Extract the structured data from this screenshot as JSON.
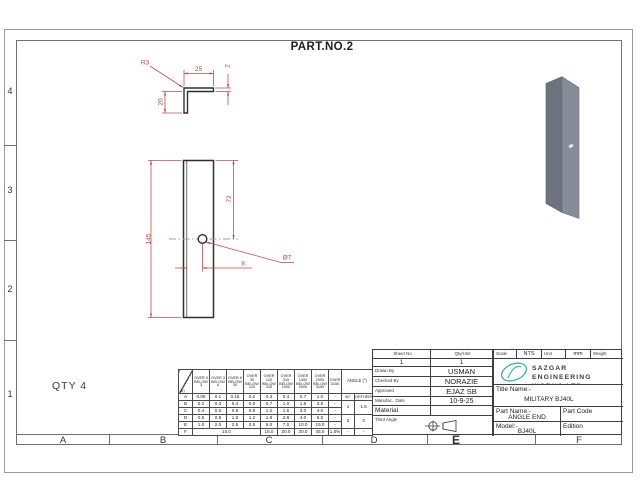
{
  "sheet": {
    "part_no": "PART.NO.2",
    "qty_note": "QTY 4"
  },
  "zones": {
    "letters": [
      "A",
      "B",
      "C",
      "D",
      "E",
      "F"
    ],
    "numbers": [
      "4",
      "3",
      "2",
      "1"
    ]
  },
  "dims": {
    "r3": "R3",
    "w25": "25",
    "t2": "2",
    "l20": "20",
    "h145": "145",
    "v72": "72",
    "dia": "Ø7",
    "off8": "8"
  },
  "tol": {
    "corner": "(±)",
    "col_headers": [
      "OVER 0 BELOW 3",
      "OVER 3 BELOW 6",
      "OVER 6 BELOW 30",
      "OVER 30 BELOW 120",
      "OVER 120 BELOW 315",
      "OVER 315 BELOW 1000",
      "OVER 1000 BELOW 2000",
      "OVER 2000 BELOW 3150",
      "OVER 3150"
    ],
    "angle_header": "ANGLE (°)",
    "rows": [
      {
        "label": "A",
        "v": [
          "0.05",
          "0.1",
          "0.15",
          "0.2",
          "0.3",
          "0.4",
          "0.7",
          "1.0",
          "-"
        ],
        "a": [
          "90°",
          "ORTHERS"
        ]
      },
      {
        "label": "B",
        "v": [
          "0.2",
          "0.3",
          "0.4",
          "0.5",
          "0.7",
          "1.0",
          "1.6",
          "2.5",
          "-"
        ],
        "a": [
          "1",
          "1.5"
        ]
      },
      {
        "label": "C",
        "v": [
          "0.4",
          "0.5",
          "0.6",
          "0.8",
          "1.2",
          "1.6",
          "3.0",
          "4.0",
          "-"
        ]
      },
      {
        "label": "D",
        "v": [
          "0.5",
          "0.8",
          "1.0",
          "1.2",
          "1.8",
          "2.8",
          "4.0",
          "6.0",
          "-"
        ],
        "a": [
          "2",
          "3"
        ]
      },
      {
        "label": "E",
        "v": [
          "1.0",
          "2.0",
          "2.5",
          "3.5",
          "5.0",
          "7.0",
          "10.0",
          "15.0",
          "-"
        ]
      },
      {
        "label": "F",
        "span": "10.0",
        "v": [
          "15.0",
          "20.0",
          "30.0",
          "45.0",
          "1.5%"
        ],
        "a": [
          "-",
          "-"
        ]
      }
    ]
  },
  "tb": {
    "sheet_no_label": "Sheet No",
    "sheet_no": "1",
    "qty_unit_label": "Qty/Unit",
    "qty_unit": "1",
    "scale_label": "Scale",
    "scale": "NTS",
    "unit_label": "Unit",
    "unit": "mm",
    "weight_label": "Weight",
    "drawn_by_label": "Drawn By",
    "drawn_by": "USMAN",
    "checked_by_label": "Checked By",
    "checked_by": "NORAZIE",
    "approved_label": "Approved",
    "approved": "EJAZ SB",
    "date_label": "Manufac., Date",
    "date": "10-9-25",
    "material_label": "Material",
    "material": "",
    "third_angle_label": "Third Angle",
    "company_line1": "SAZGAR ENGINEERING",
    "company_line2": "WORKS LTD.",
    "title_name_label": "Title Name:-",
    "title_name": "MILITARY BJ40L",
    "part_name_label": "Part Name:-",
    "part_name": "ANGLE END",
    "part_code_label": "Part Code",
    "model_label": "Model:-",
    "model": "BJ40L",
    "edition_label": "Edition"
  },
  "colors": {
    "dimension": "#b5453f",
    "centerline": "#8fa3c8",
    "logo_teal": "#35a9a2",
    "part_dark": "#6d7480",
    "part_light": "#868d99"
  }
}
